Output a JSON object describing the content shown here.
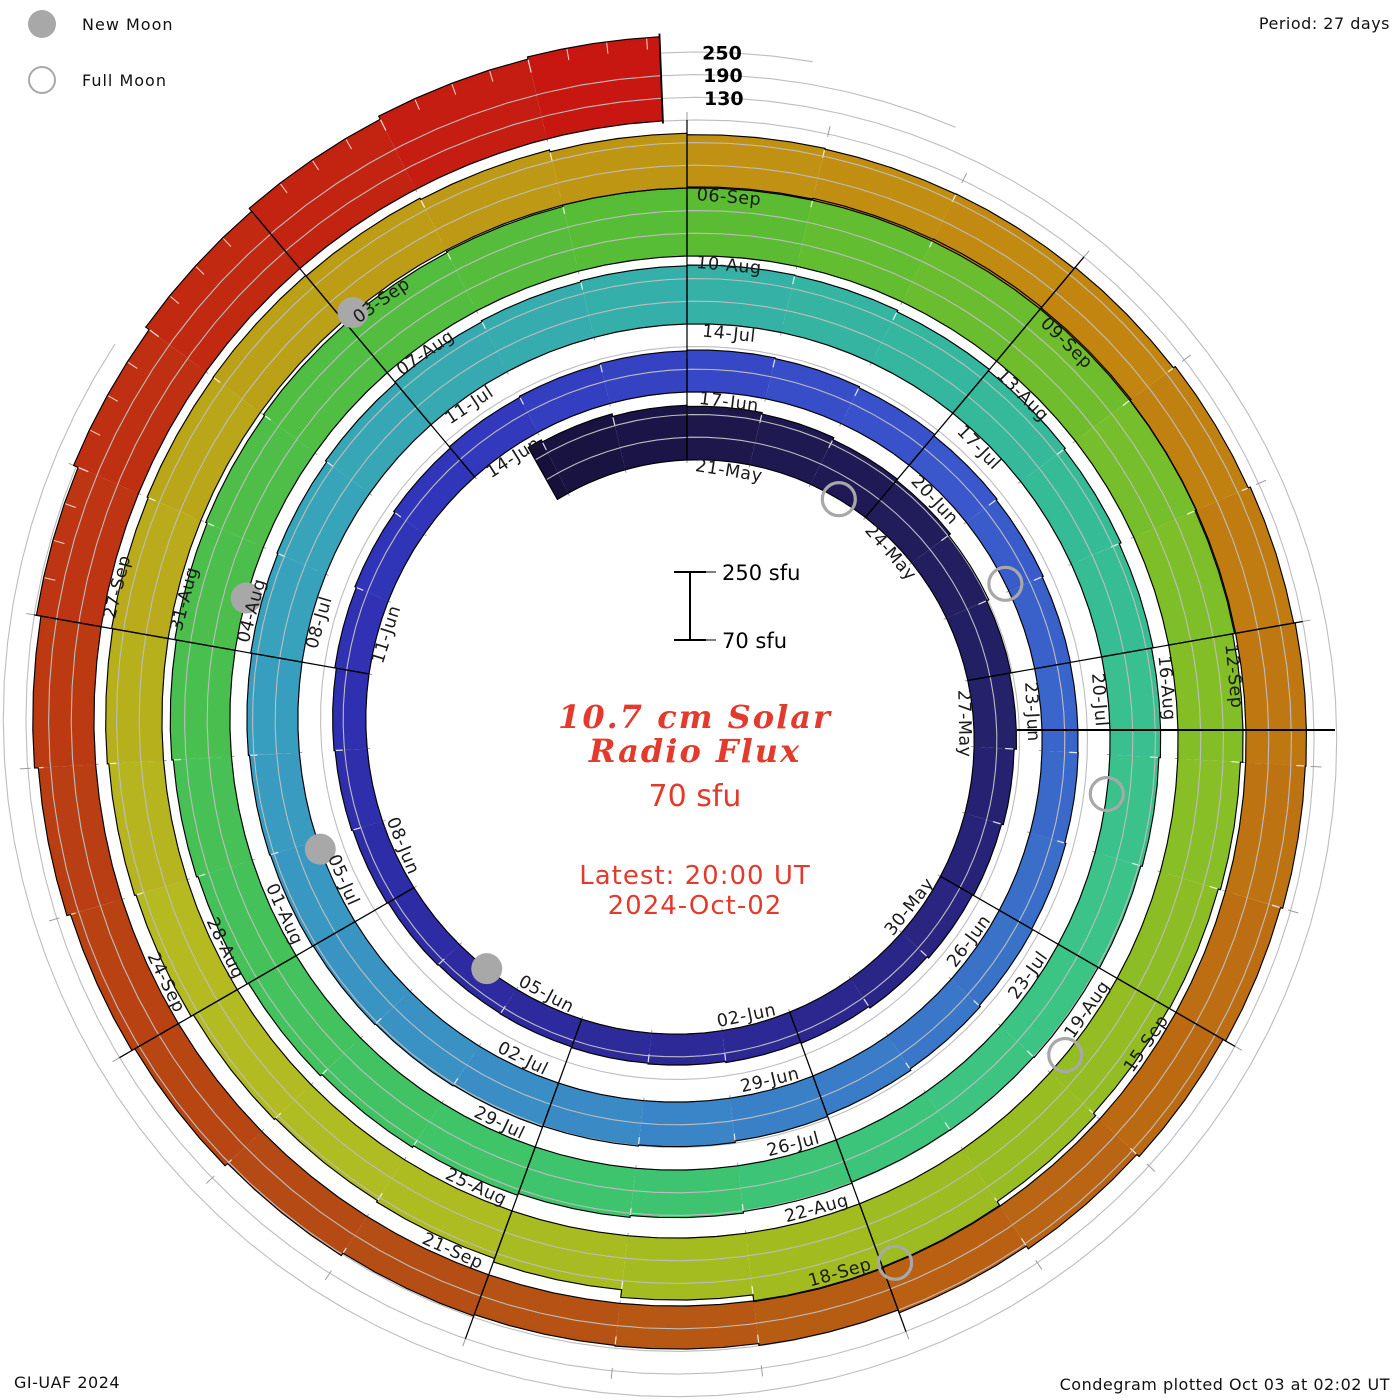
{
  "legend": {
    "new_moon": "New Moon",
    "full_moon": "Full Moon"
  },
  "header": {
    "period": "Period: 27 days"
  },
  "footer": {
    "left": "GI-UAF 2024",
    "right": "Condegram plotted Oct 03 at 02:02 UT"
  },
  "center": {
    "scale_top": "250 sfu",
    "scale_bottom": "70 sfu",
    "title_line1": "10.7 cm Solar",
    "title_line2": "Radio Flux",
    "subtitle": "70 sfu",
    "latest_line1": "Latest: 20:00 UT",
    "latest_line2": "2024-Oct-02",
    "accent_color": "#e23b2e"
  },
  "chart_data": {
    "type": "spiral-condegram",
    "title": "10.7 cm Solar Radio Flux",
    "units": "sfu",
    "period_days": 27,
    "day_zero_date": "2024-05-21",
    "t_min": -2.2,
    "t_max": 134.83,
    "center_px": [
      687,
      730
    ],
    "r0_px": 270,
    "ring_spacing_px": 68,
    "sfu_at_baseline": 70,
    "sfu_per_ring": 180,
    "grid_offsets_sfu": [
      70,
      130,
      190
    ],
    "grid_extend_t": [
      163,
      158,
      137
    ],
    "grid_tick_end_t": 161,
    "radial_axis": {
      "tick_values": [
        130,
        190,
        250
      ]
    },
    "seam": {
      "angle_deg": 90,
      "r_inner": 330,
      "r_outer": 648
    },
    "end_line": {
      "r_inner": 607,
      "r_outer": 697
    },
    "label_start_t": 0,
    "label_step": 3,
    "labels": [
      "21-May",
      "24-May",
      "27-May",
      "30-May",
      "02-Jun",
      "05-Jun",
      "08-Jun",
      "11-Jun",
      "14-Jun",
      "17-Jun",
      "20-Jun",
      "23-Jun",
      "26-Jun",
      "29-Jun",
      "02-Jul",
      "05-Jul",
      "08-Jul",
      "11-Jul",
      "14-Jul",
      "17-Jul",
      "20-Jul",
      "23-Jul",
      "26-Jul",
      "29-Jul",
      "01-Aug",
      "04-Aug",
      "07-Aug",
      "10-Aug",
      "13-Aug",
      "16-Aug",
      "19-Aug",
      "22-Aug",
      "25-Aug",
      "28-Aug",
      "31-Aug",
      "03-Sep",
      "06-Sep",
      "09-Sep",
      "12-Sep",
      "15-Sep",
      "18-Sep",
      "21-Sep",
      "24-Sep",
      "27-Sep"
    ],
    "flux_start_t": -3,
    "flux_daily_sfu": [
      228,
      222,
      215,
      212,
      208,
      202,
      198,
      192,
      186,
      182,
      176,
      171,
      168,
      163,
      158,
      155,
      152,
      150,
      148,
      147,
      149,
      152,
      155,
      158,
      162,
      166,
      170,
      174,
      177,
      179,
      181,
      179,
      176,
      172,
      169,
      166,
      165,
      166,
      169,
      172,
      176,
      180,
      184,
      188,
      191,
      194,
      196,
      198,
      200,
      202,
      205,
      208,
      211,
      215,
      218,
      221,
      224,
      226,
      225,
      221,
      217,
      213,
      208,
      204,
      200,
      196,
      192,
      190,
      189,
      192,
      196,
      201,
      206,
      211,
      216,
      220,
      224,
      228,
      232,
      236,
      240,
      243,
      246,
      250,
      253,
      255,
      256,
      254,
      251,
      247,
      242,
      236,
      230,
      228,
      236,
      248,
      252,
      234,
      214,
      204,
      200,
      204,
      211,
      215,
      219,
      222,
      225,
      226,
      224,
      220,
      215,
      211,
      209,
      210,
      214,
      220,
      226,
      230,
      228,
      222,
      214,
      206,
      197,
      189,
      184,
      182,
      186,
      194,
      203,
      212,
      222,
      232,
      244,
      257,
      268,
      278,
      287,
      293
    ],
    "colormap_anchors": [
      [
        -3,
        "#150f38"
      ],
      [
        0,
        "#1c164a"
      ],
      [
        6,
        "#242066"
      ],
      [
        12,
        "#2c2892"
      ],
      [
        18,
        "#2e2ca6"
      ],
      [
        24,
        "#3136bc"
      ],
      [
        30,
        "#3a55cc"
      ],
      [
        36,
        "#3a70c8"
      ],
      [
        42,
        "#3a8cc6"
      ],
      [
        48,
        "#38a0be"
      ],
      [
        54,
        "#35b0a8"
      ],
      [
        57,
        "#34b89c"
      ],
      [
        63,
        "#3cc487"
      ],
      [
        69,
        "#3ec46a"
      ],
      [
        75,
        "#4abe4e"
      ],
      [
        81,
        "#58bc34"
      ],
      [
        87,
        "#80be28"
      ],
      [
        93,
        "#a0bc20"
      ],
      [
        99,
        "#b4bc22"
      ],
      [
        105,
        "#bc9e16"
      ],
      [
        111,
        "#c28810"
      ],
      [
        117,
        "#bc6c12"
      ],
      [
        123,
        "#b45014"
      ],
      [
        129,
        "#bc3812"
      ],
      [
        135,
        "#c81410"
      ]
    ],
    "moons": {
      "full_moon_t": [
        2.5,
        31.9,
        61.4,
        90.8,
        119.9
      ],
      "new_moon_t": [
        16.5,
        45.9,
        75.5,
        105.1
      ]
    },
    "style": {
      "grid_color": "#bdbdbd",
      "tick_color": "#9c9c9c",
      "outline_color": "#000000",
      "moon_color": "#a8a8a8",
      "label_color": "#1a1a1a"
    }
  }
}
